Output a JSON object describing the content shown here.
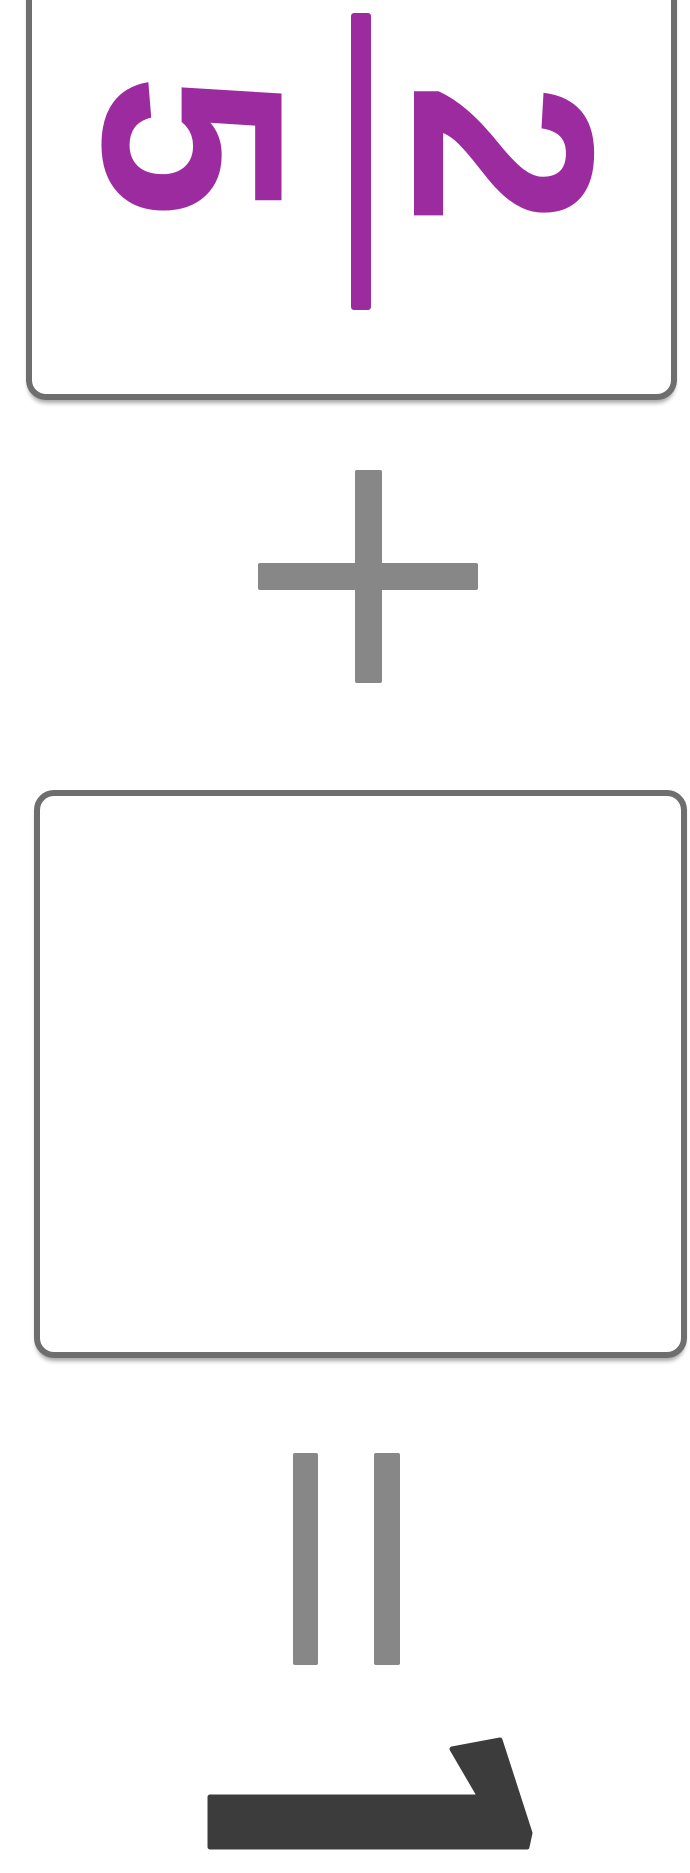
{
  "exercise": {
    "fraction_card": {
      "numerator": "2",
      "denominator": "5"
    },
    "plus_label": "+",
    "equals_label": "=",
    "answer_box_value": "",
    "submit_icon": "checkmark-arrow-icon"
  },
  "colors": {
    "fraction_purple": "#9c2b9f",
    "operator_gray": "#878787",
    "card_border_gray": "#6e6e6e",
    "arrow_dark": "#3c3c3c",
    "background": "#ffffff"
  }
}
